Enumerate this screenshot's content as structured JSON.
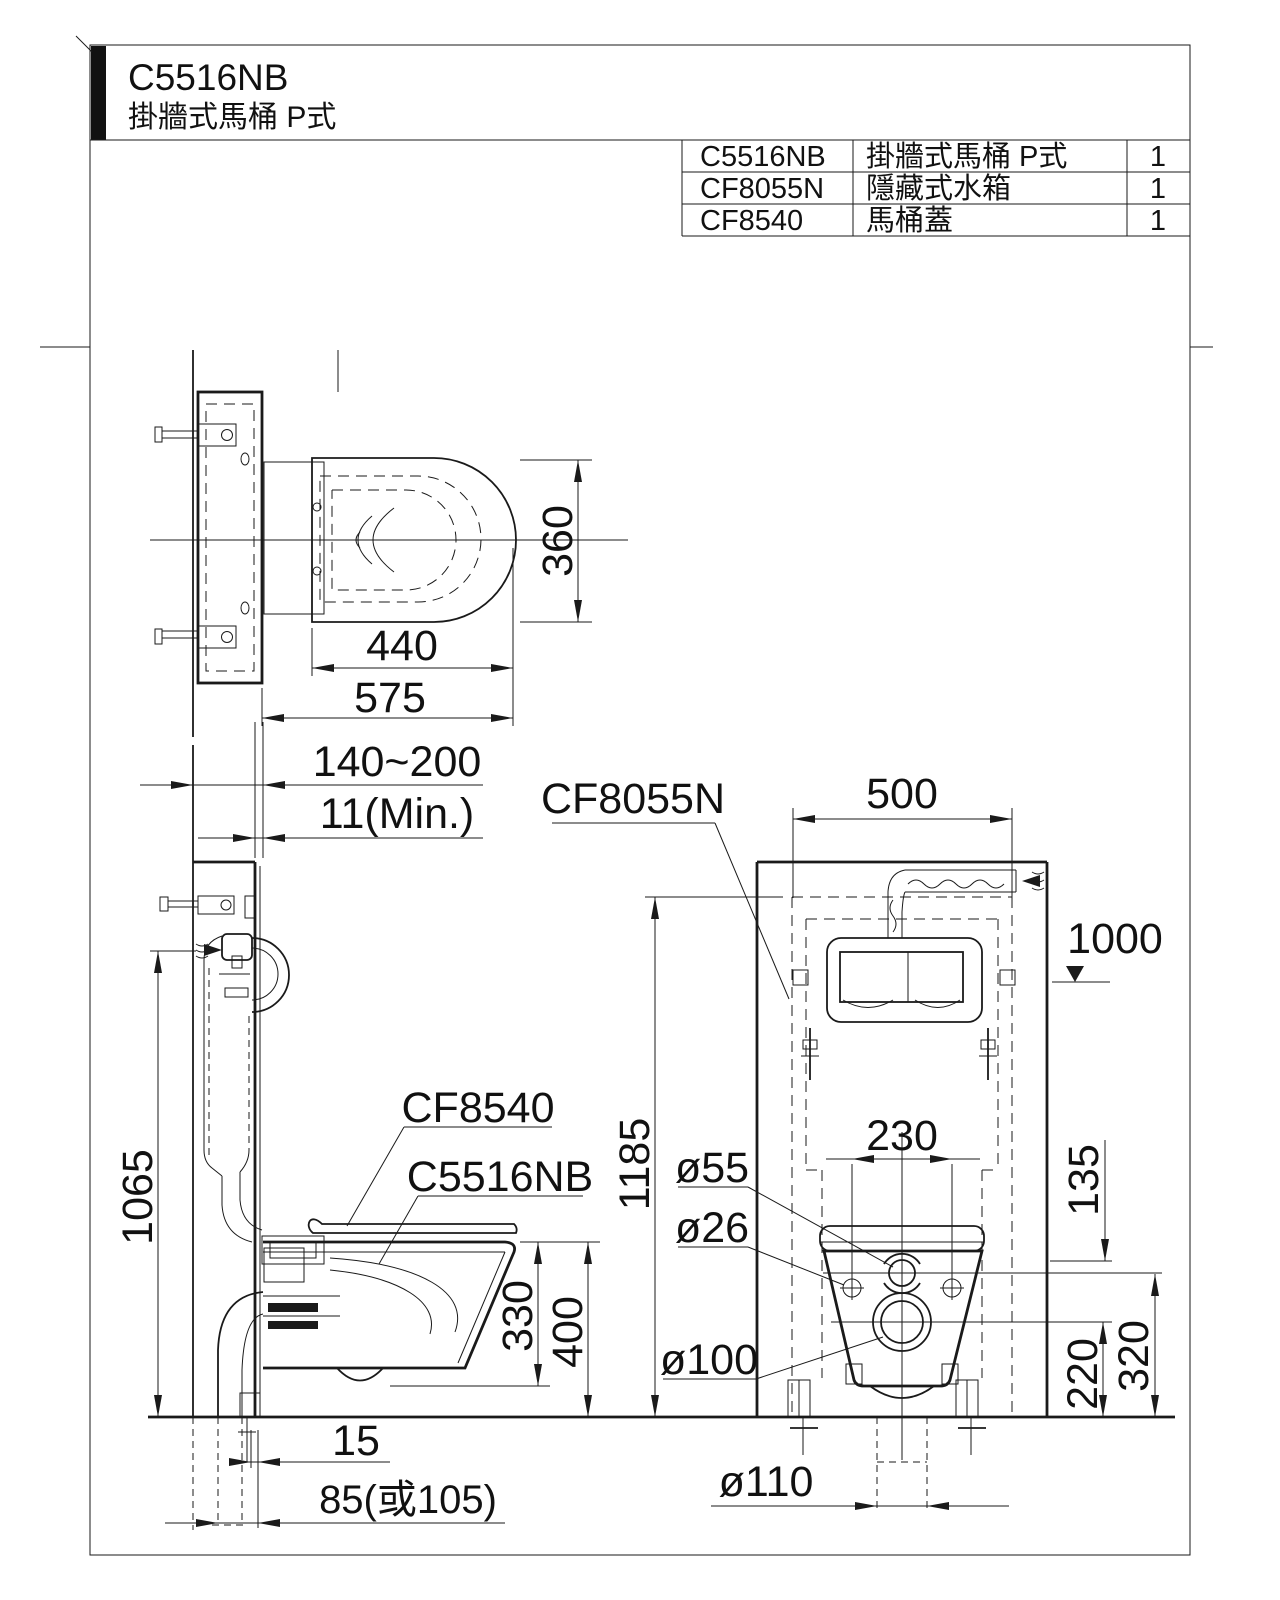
{
  "title": {
    "model": "C5516NB",
    "subtitle": "掛牆式馬桶 P式"
  },
  "parts_table": {
    "rows": [
      {
        "code": "C5516NB",
        "name": "掛牆式馬桶 P式",
        "qty": "1"
      },
      {
        "code": "CF8055N",
        "name": "隱藏式水箱",
        "qty": "1"
      },
      {
        "code": "CF8540",
        "name": "馬桶蓋",
        "qty": "1"
      }
    ]
  },
  "plan_view": {
    "bowl_width": "360",
    "bowl_length": "440",
    "overall_depth": "575"
  },
  "side_view": {
    "wall_depth_range": "140~200",
    "panel_min_thickness": "11(Min.)",
    "actuator_height": "1065",
    "seat_label": "CF8540",
    "bowl_label": "C5516NB",
    "bowl_height": "330",
    "rim_height": "400",
    "outlet_offset": "15",
    "outlet_offset_alt": "85(或105)"
  },
  "front_view": {
    "tank_label": "CF8055N",
    "frame_width": "500",
    "supply_height": "1000",
    "frame_height": "1185",
    "bolt_spacing": "230",
    "bracket_drop": "135",
    "drain_center_height": "220",
    "inlet_center_height": "320",
    "inlet_dia": "ø55",
    "bolt_hole_dia": "ø26",
    "drain_dia": "ø100",
    "soil_pipe_dia": "ø110"
  }
}
